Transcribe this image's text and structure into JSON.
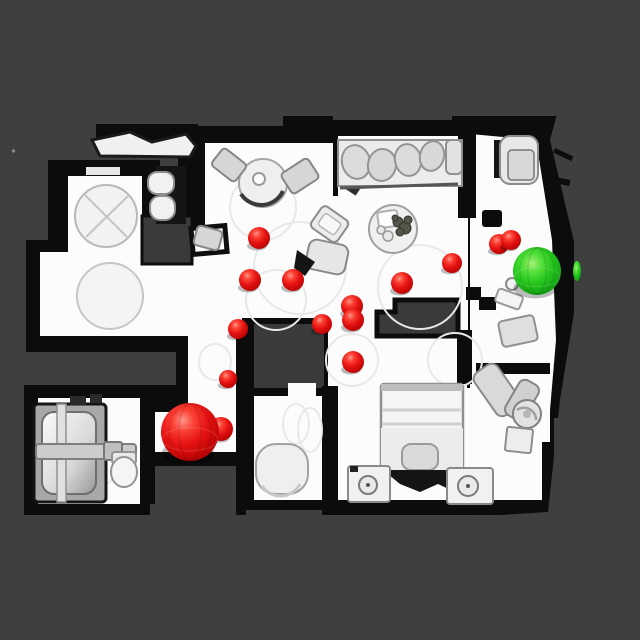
{
  "view": {
    "width": 640,
    "height": 640
  },
  "palette": {
    "background": "#3f3f3f",
    "floor": "#fcfcfc",
    "wall": "#0c0c0c",
    "floor_hole": "#3a3a3a",
    "furniture_light": "#ececec",
    "waypoint_red": "#e41212",
    "goal_green": "#25c51c"
  },
  "markers": {
    "waypoints": [
      {
        "x": 259,
        "y": 238,
        "r": 11
      },
      {
        "x": 250,
        "y": 280,
        "r": 11
      },
      {
        "x": 293,
        "y": 280,
        "r": 11
      },
      {
        "x": 322,
        "y": 324,
        "r": 10
      },
      {
        "x": 352,
        "y": 306,
        "r": 11
      },
      {
        "x": 353,
        "y": 320,
        "r": 11
      },
      {
        "x": 353,
        "y": 362,
        "r": 11
      },
      {
        "x": 402,
        "y": 283,
        "r": 11
      },
      {
        "x": 452,
        "y": 263,
        "r": 10
      },
      {
        "x": 499,
        "y": 244,
        "r": 10
      },
      {
        "x": 511,
        "y": 240,
        "r": 10
      },
      {
        "x": 238,
        "y": 329,
        "r": 10
      },
      {
        "x": 228,
        "y": 379,
        "r": 9
      }
    ],
    "agent": {
      "x": 190,
      "y": 432,
      "r": 29
    },
    "agent_secondary": {
      "x": 221,
      "y": 429,
      "r": 12
    },
    "goal": {
      "x": 537,
      "y": 271,
      "r": 24
    },
    "goal_sliver": {
      "x": 577,
      "y": 271,
      "rx": 4,
      "ry": 10
    }
  }
}
